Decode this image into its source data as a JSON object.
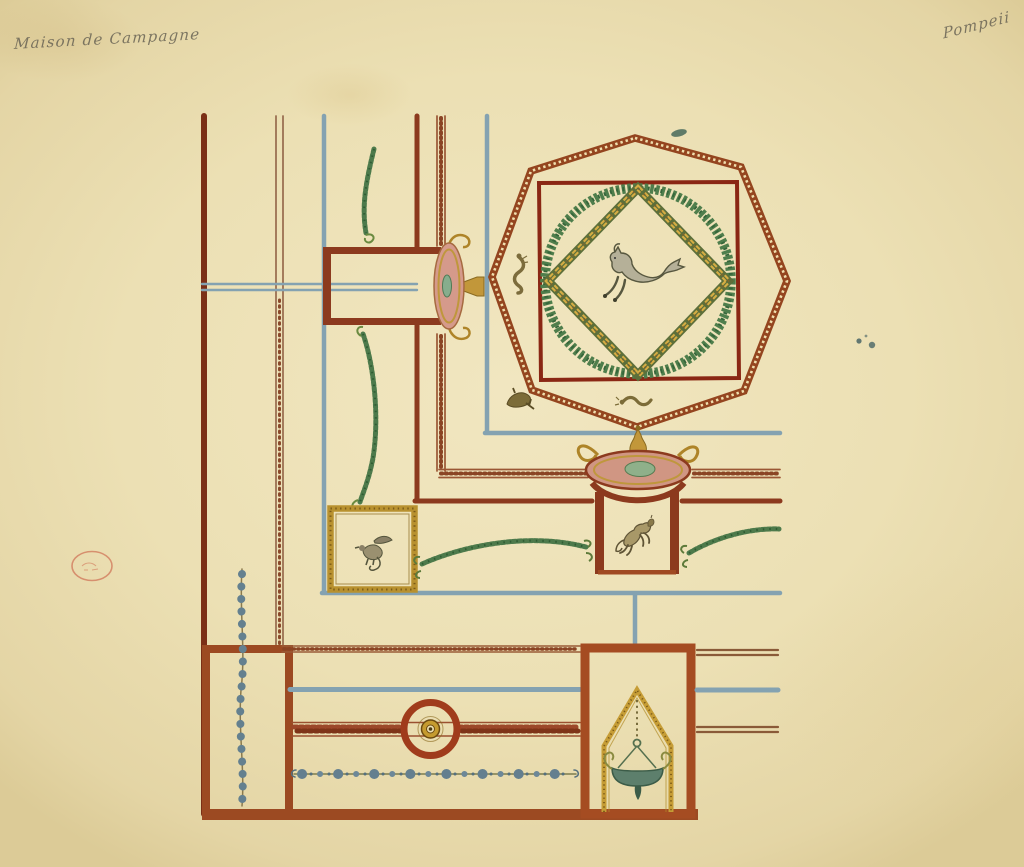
{
  "document": {
    "type": "watercolor architectural drawing of a painted ceiling / wall decoration scheme",
    "annotations": {
      "top_left": "Maison de Campagne",
      "top_right": "Pompeii"
    },
    "stamp": {
      "kind": "faint oval collection stamp",
      "color": "#c8523a"
    },
    "palette": {
      "paper": "#ece0b4",
      "red_brown_border": "#9c4a22",
      "dark_red_line": "#8a2714",
      "octagon_band": "#94451f",
      "blue_band": "#84a2b1",
      "garland_green": "#4d7a4b",
      "wreath_green": "#4f7e4c",
      "gold": "#c49a33",
      "table_pink": "#d09683",
      "bead_blue_gray": "#64808f",
      "figure_olive": "#7c6c3c",
      "pencil": "#6c6656"
    },
    "motifs": [
      "octagon medallion with beaded band",
      "dark red square frame",
      "green laurel wreath circle",
      "gold lozenge (diamond) band",
      "central hippocamp (sea-horse) figure",
      "small sea-serpent and dolphin figures",
      "gold framed square panel with griffin",
      "two tripod tables with pink oval tops and gold scrolls",
      "rearing horse in table niche",
      "green garlands and swags",
      "blue bead chain",
      "rosette chain border",
      "guilloche band with circular boss medallion",
      "gabled gold niche with hanging bronze lamp"
    ]
  }
}
